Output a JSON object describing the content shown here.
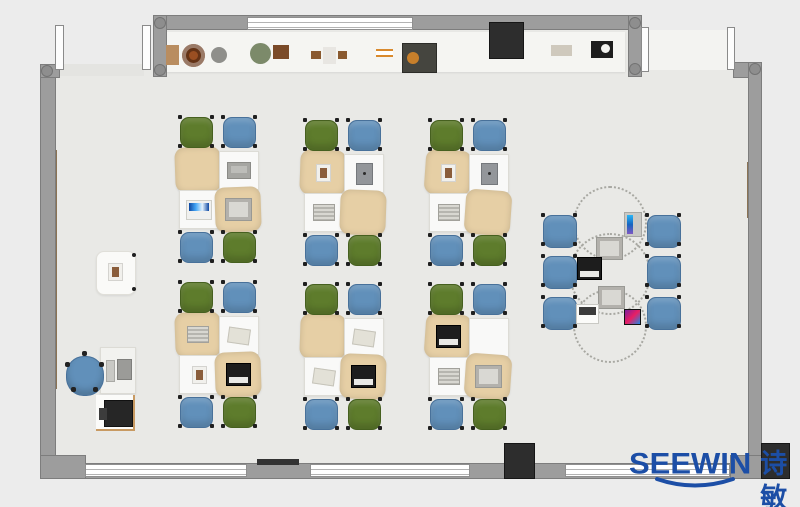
{
  "brand": {
    "name": "SEEWIN",
    "cjk": "诗敏",
    "color": "#1c4ea6"
  },
  "palette": {
    "outside": "#ececec",
    "floor": "#e9e9e6",
    "shelf": "#f5f5f2",
    "wall": "#9d9d9d",
    "wall_dark": "#7d7d7d",
    "pillar": "#2d2d2d",
    "chair_blue": "#6190ba",
    "chair_blue_dark": "#48719a",
    "chair_green": "#5e7c2c",
    "chair_green_dark": "#46601f",
    "desk_white": "#f9f9f8",
    "desk_tan": "#e6cfa5",
    "strip_green": "#35d598",
    "strip_brown": "#8b7354",
    "wood": "#c89a62",
    "brand": "#1c4ea6"
  },
  "plan": {
    "cluster_layout": {
      "desk_w": 40,
      "desk_h": 39,
      "chair_w": 33,
      "chair_h": 31,
      "top_seats": [
        "green",
        "blue"
      ],
      "bottom_seats": [
        "blue",
        "green"
      ],
      "tan_desks": [
        "tl",
        "br"
      ]
    },
    "clusters": [
      {
        "id": "row1-left",
        "x": 178,
        "y": 150,
        "items": {
          "tl": null,
          "tr": "laptop-gray",
          "bl": "laptop-blue",
          "br": "book-gray"
        }
      },
      {
        "id": "row1-mid",
        "x": 303,
        "y": 153,
        "items": {
          "tl": "photo",
          "tr": "tablet",
          "bl": "book",
          "br": null
        }
      },
      {
        "id": "row1-right",
        "x": 428,
        "y": 153,
        "items": {
          "tl": "photo",
          "tr": "tablet",
          "bl": "book",
          "br": null
        }
      },
      {
        "id": "row2-left",
        "x": 178,
        "y": 315,
        "items": {
          "tl": "book",
          "tr": "paper",
          "bl": "photo",
          "br": "laptop-black"
        }
      },
      {
        "id": "row2-mid",
        "x": 303,
        "y": 317,
        "items": {
          "tl": null,
          "tr": "paper",
          "bl": "paper",
          "br": "laptop-black"
        }
      },
      {
        "id": "row2-right",
        "x": 428,
        "y": 317,
        "items": {
          "tl": "laptop-black",
          "tr": null,
          "bl": "book",
          "br": "book-gray"
        }
      }
    ],
    "round_area": {
      "circles": [
        {
          "cx": 610,
          "cy": 223,
          "r": 37
        },
        {
          "cx": 610,
          "cy": 274,
          "r": 41
        },
        {
          "cx": 610,
          "cy": 326,
          "r": 37
        }
      ],
      "chairs": [
        [
          543,
          215
        ],
        [
          543,
          256
        ],
        [
          543,
          297
        ],
        [
          647,
          215
        ],
        [
          647,
          256
        ],
        [
          647,
          297
        ]
      ],
      "devices": [
        {
          "type": "tablet-blue",
          "x": 624,
          "y": 212
        },
        {
          "type": "book-gray",
          "x": 596,
          "y": 237
        },
        {
          "type": "laptop-black",
          "x": 577,
          "y": 257
        },
        {
          "type": "book-gray",
          "x": 598,
          "y": 286
        },
        {
          "type": "laptop-white",
          "x": 576,
          "y": 304
        },
        {
          "type": "phone",
          "x": 624,
          "y": 309
        }
      ]
    },
    "teacher": {
      "side_table": {
        "x": 96,
        "y": 251,
        "w": 38,
        "h": 42
      },
      "chair": {
        "x": 66,
        "y": 356,
        "w": 36,
        "h": 38
      },
      "desk": {
        "x": 100,
        "y": 347,
        "w": 34,
        "h": 45
      },
      "monitor": {
        "x": 117,
        "y": 359,
        "w": 13,
        "h": 19
      },
      "keyboard": {
        "x": 106,
        "y": 360,
        "w": 7,
        "h": 20
      },
      "printer_mat": {
        "x": 96,
        "y": 395,
        "w": 39,
        "h": 36
      },
      "printer": {
        "x": 104,
        "y": 400,
        "w": 27,
        "h": 25
      }
    },
    "shelf_items": [
      {
        "n": "storage-box",
        "cls": "",
        "x": 166,
        "y": 45,
        "w": 13,
        "h": 20,
        "c": "#b98d60"
      },
      {
        "n": "round-plate",
        "cls": "si-ring",
        "x": 182,
        "y": 44,
        "w": 23,
        "h": 23,
        "c": "#9a4f22"
      },
      {
        "n": "stone-bowl",
        "cls": "si-round",
        "x": 211,
        "y": 47,
        "w": 16,
        "h": 16,
        "c": "#8f8f8b"
      },
      {
        "n": "plant-pot",
        "cls": "si-round",
        "x": 250,
        "y": 43,
        "w": 21,
        "h": 21,
        "c": "#7c8a6a"
      },
      {
        "n": "photo-frame",
        "cls": "",
        "x": 273,
        "y": 45,
        "w": 16,
        "h": 14,
        "c": "#7a4a28"
      },
      {
        "n": "wood-block-a",
        "cls": "",
        "x": 311,
        "y": 51,
        "w": 10,
        "h": 8,
        "c": "#8a5a30"
      },
      {
        "n": "white-box",
        "cls": "",
        "x": 323,
        "y": 47,
        "w": 13,
        "h": 17,
        "c": "#e8e6e2"
      },
      {
        "n": "wood-block-b",
        "cls": "",
        "x": 338,
        "y": 51,
        "w": 9,
        "h": 8,
        "c": "#8a5a30"
      },
      {
        "n": "orange-rails",
        "cls": "si-rails",
        "x": 376,
        "y": 49,
        "w": 17,
        "h": 8,
        "c": ""
      },
      {
        "n": "toolbox",
        "cls": "si-toolbox",
        "x": 402,
        "y": 43,
        "w": 35,
        "h": 30,
        "c": ""
      },
      {
        "n": "small-tray",
        "cls": "",
        "x": 551,
        "y": 45,
        "w": 21,
        "h": 11,
        "c": "#cfc9bd"
      },
      {
        "n": "camera-device",
        "cls": "si-camera",
        "x": 591,
        "y": 41,
        "w": 22,
        "h": 17,
        "c": ""
      }
    ],
    "pillars": [
      {
        "x": 489,
        "y": 22,
        "w": 35,
        "h": 37
      },
      {
        "x": 504,
        "y": 443,
        "w": 31,
        "h": 36
      },
      {
        "x": 761,
        "y": 443,
        "w": 29,
        "h": 36
      }
    ],
    "doors": [
      {
        "x": 55,
        "y": 25,
        "w": 9,
        "h": 45
      },
      {
        "x": 142,
        "y": 25,
        "w": 9,
        "h": 45
      },
      {
        "x": 641,
        "y": 27,
        "w": 8,
        "h": 45
      },
      {
        "x": 727,
        "y": 27,
        "w": 8,
        "h": 43
      }
    ],
    "windows_bottom": [
      {
        "x": 85,
        "y": 464,
        "w": 162,
        "h": 13
      },
      {
        "x": 310,
        "y": 464,
        "w": 160,
        "h": 13
      },
      {
        "x": 565,
        "y": 464,
        "w": 165,
        "h": 13
      }
    ],
    "window_top": {
      "x": 247,
      "y": 17,
      "w": 166,
      "h": 13
    },
    "posts": [
      [
        154,
        17
      ],
      [
        629,
        17
      ],
      [
        629,
        63
      ],
      [
        749,
        63
      ],
      [
        41,
        65
      ],
      [
        154,
        64
      ]
    ]
  }
}
